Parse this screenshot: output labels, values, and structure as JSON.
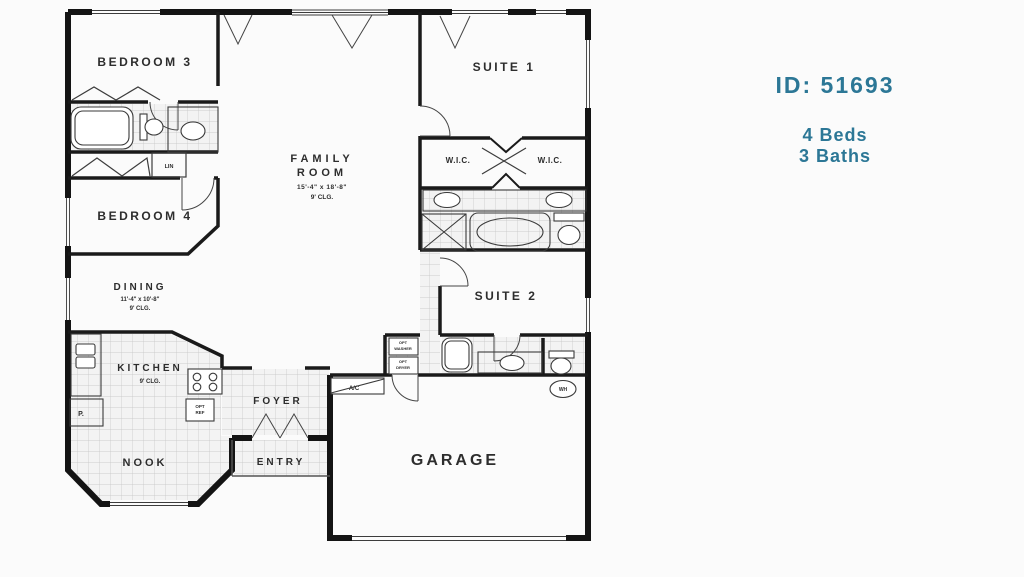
{
  "info": {
    "id_label": "ID: 51693",
    "beds": "4 Beds",
    "baths": "3 Baths",
    "accent_color": "#2c7796"
  },
  "plan": {
    "bedroom3": "BEDROOM 3",
    "bedroom4": "BEDROOM 4",
    "family_line1": "FAMILY",
    "family_line2": "ROOM",
    "family_dims": "15'-4\" x 18'-8\"",
    "family_clg": "9' CLG.",
    "suite1": "SUITE 1",
    "wic_left": "W.I.C.",
    "wic_right": "W.I.C.",
    "suite2": "SUITE 2",
    "dining": "DINING",
    "dining_dims": "11'-4\" x 10'-8\"",
    "dining_clg": "9' CLG.",
    "kitchen": "KITCHEN",
    "kitchen_clg": "9' CLG.",
    "nook": "NOOK",
    "foyer": "FOYER",
    "entry": "ENTRY",
    "garage": "GARAGE",
    "ac": "A/C",
    "wh": "WH",
    "lin": "LIN",
    "pantry": "P.",
    "opt_ref_1": "OPT",
    "opt_ref_2": "REF",
    "washer_1": "OPT",
    "washer_2": "WASHER",
    "dryer_1": "OPT",
    "dryer_2": "DRYER"
  }
}
